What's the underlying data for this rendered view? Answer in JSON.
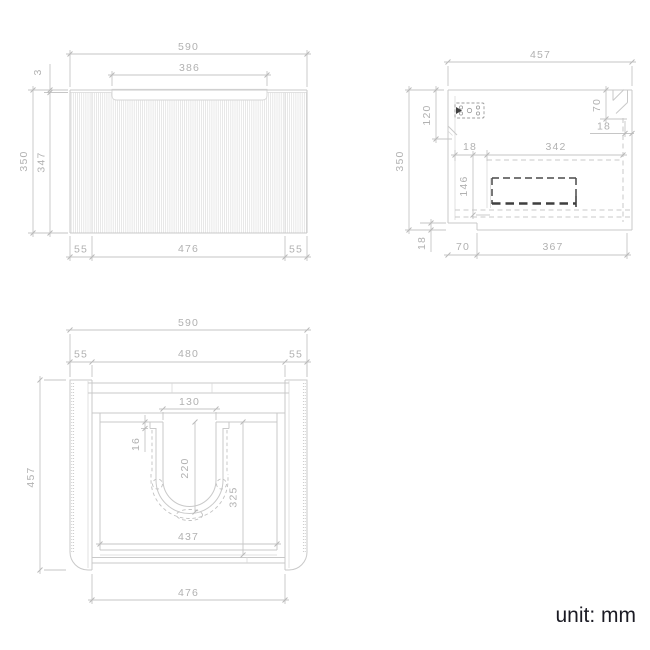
{
  "unit_note": "unit: mm",
  "views": {
    "front": {
      "dims": {
        "overall_width": "590",
        "handle_width": "386",
        "top_reveal": "3",
        "overall_height": "350",
        "panel_height": "347",
        "bottom_left": "55",
        "bottom_center": "476",
        "bottom_right": "55"
      }
    },
    "side": {
      "dims": {
        "overall_depth": "457",
        "overall_height": "350",
        "bracket_drop": "120",
        "handle_drop": "70",
        "front_thickness": "18",
        "back_gap": "18",
        "drawer_depth": "342",
        "drawer_height": "146",
        "bottom_thickness": "18",
        "bottom_setback": "70",
        "bottom_run": "367"
      }
    },
    "plan": {
      "dims": {
        "overall_width": "590",
        "left_panel": "55",
        "inner_width": "480",
        "right_panel": "55",
        "overall_depth": "457",
        "cutout_width": "130",
        "lip_depth": "16",
        "cutout_depth": "220",
        "inner_depth": "325",
        "inner_width_2": "437",
        "front_opening": "476"
      }
    }
  }
}
